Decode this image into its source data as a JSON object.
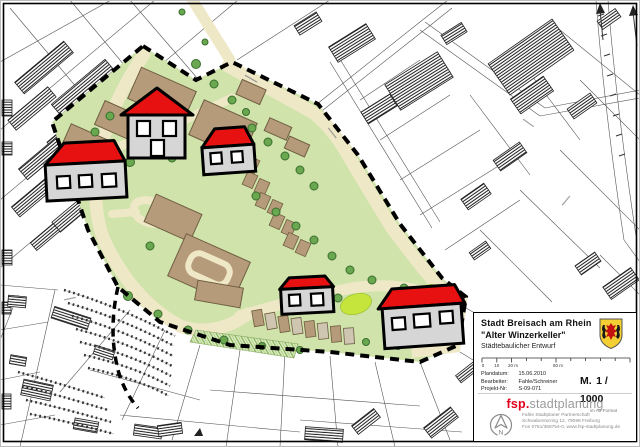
{
  "title_block": {
    "municipality": "Stadt Breisach am Rhein",
    "project_title": "\"Alter Winzerkeller\"",
    "subtitle": "Städtebaulicher Entwurf",
    "scale_bar_labels": [
      "0",
      "10",
      "20 m",
      "50 m"
    ],
    "meta": [
      {
        "label": "Plandatum:",
        "value": "15.06.2010"
      },
      {
        "label": "Bearbeiter:",
        "value": "Fahle/Schreiner"
      },
      {
        "label": "Projekt-Nr:",
        "value": "S-09-071"
      }
    ],
    "scale_label": "M.",
    "scale_value": "1 / 1000",
    "scale_note": "im A3-Format",
    "firm": {
      "logo_prefix": "fsp.",
      "logo_suffix": "stadtplanung",
      "address_lines": [
        "Fahle Stadtplaner Partnerschaft",
        "Schwabentorring 12, 79098 Freiburg",
        "Fon 0761/368754-0, www.fsp-stadtplanung.de"
      ]
    },
    "compass_label": "N"
  },
  "colors": {
    "site_green": "#cfe3ab",
    "street_cream": "#efe8c7",
    "building_brown": "#b59b79",
    "roof_red": "#e81111",
    "house_gray": "#d6d6d6",
    "tree_green": "#69a84f",
    "bright_green": "#c6e53c",
    "accent_red": "#e2001a",
    "wappen_yellow": "#f3cf33",
    "boundary_black": "#000000"
  }
}
